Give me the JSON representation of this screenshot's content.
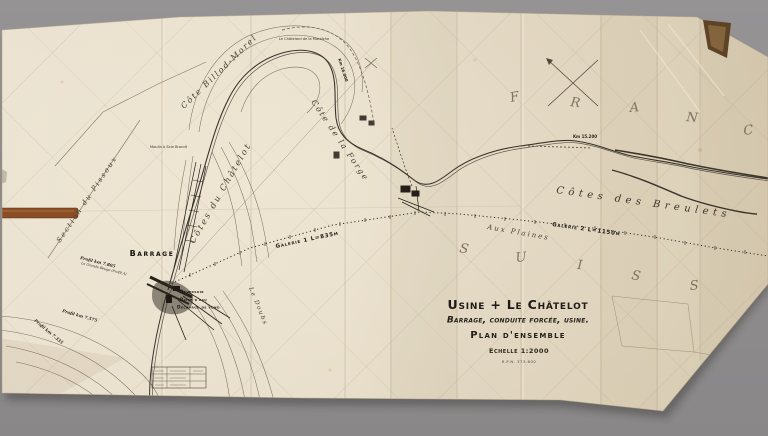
{
  "photo": {
    "background_color": "#908f90",
    "paper_color": "#e6dcc8",
    "ink_color": "#3a332a",
    "tape_color": "#8a4e26"
  },
  "title_block": {
    "title": "Usine + Le Châtelot",
    "subtitle": "Barrage, conduite forcée, usine.",
    "plan": "Plan d'ensemble",
    "scale": "Echelle 1:2000",
    "reference": "R.P.N. 373.600"
  },
  "countries": {
    "france": [
      "F",
      "R",
      "A",
      "N",
      "C"
    ],
    "suisse": [
      "S",
      "U",
      "I",
      "S",
      "S"
    ]
  },
  "labels": {
    "barrage": "Barrage",
    "deversoir": "Déversoir",
    "prise_eau": "Prise d'eau",
    "decharge": "Decharge de fond",
    "galerie1": "Galerie 1  L=835m",
    "galerie2": "Galerie 2  L=1150m",
    "cotes_breulets": "Côtes des Breulets",
    "cote_billod": "Côte Billod-Morel",
    "cotes_chatelot": "Côtes du Châtelot",
    "cote_forge": "Côte de la Forge",
    "section_pissoux": "Section du Pissoux",
    "aux_plaines": "Aux Plaines",
    "le_doubs": "Le Doubs",
    "chatelard": "Le Châtelard de la Maraîche",
    "moulin": "Moulin à Scie Brandt",
    "km_16000": "Km 16.000",
    "km_15200": "Km 15.200",
    "profil_7805": "Profil km 7.805",
    "grande_beuge": "La Grande Beuge (Profil A)",
    "profil_7575": "Profil km 7.575",
    "profil_7335": "Profil km 7.335"
  }
}
